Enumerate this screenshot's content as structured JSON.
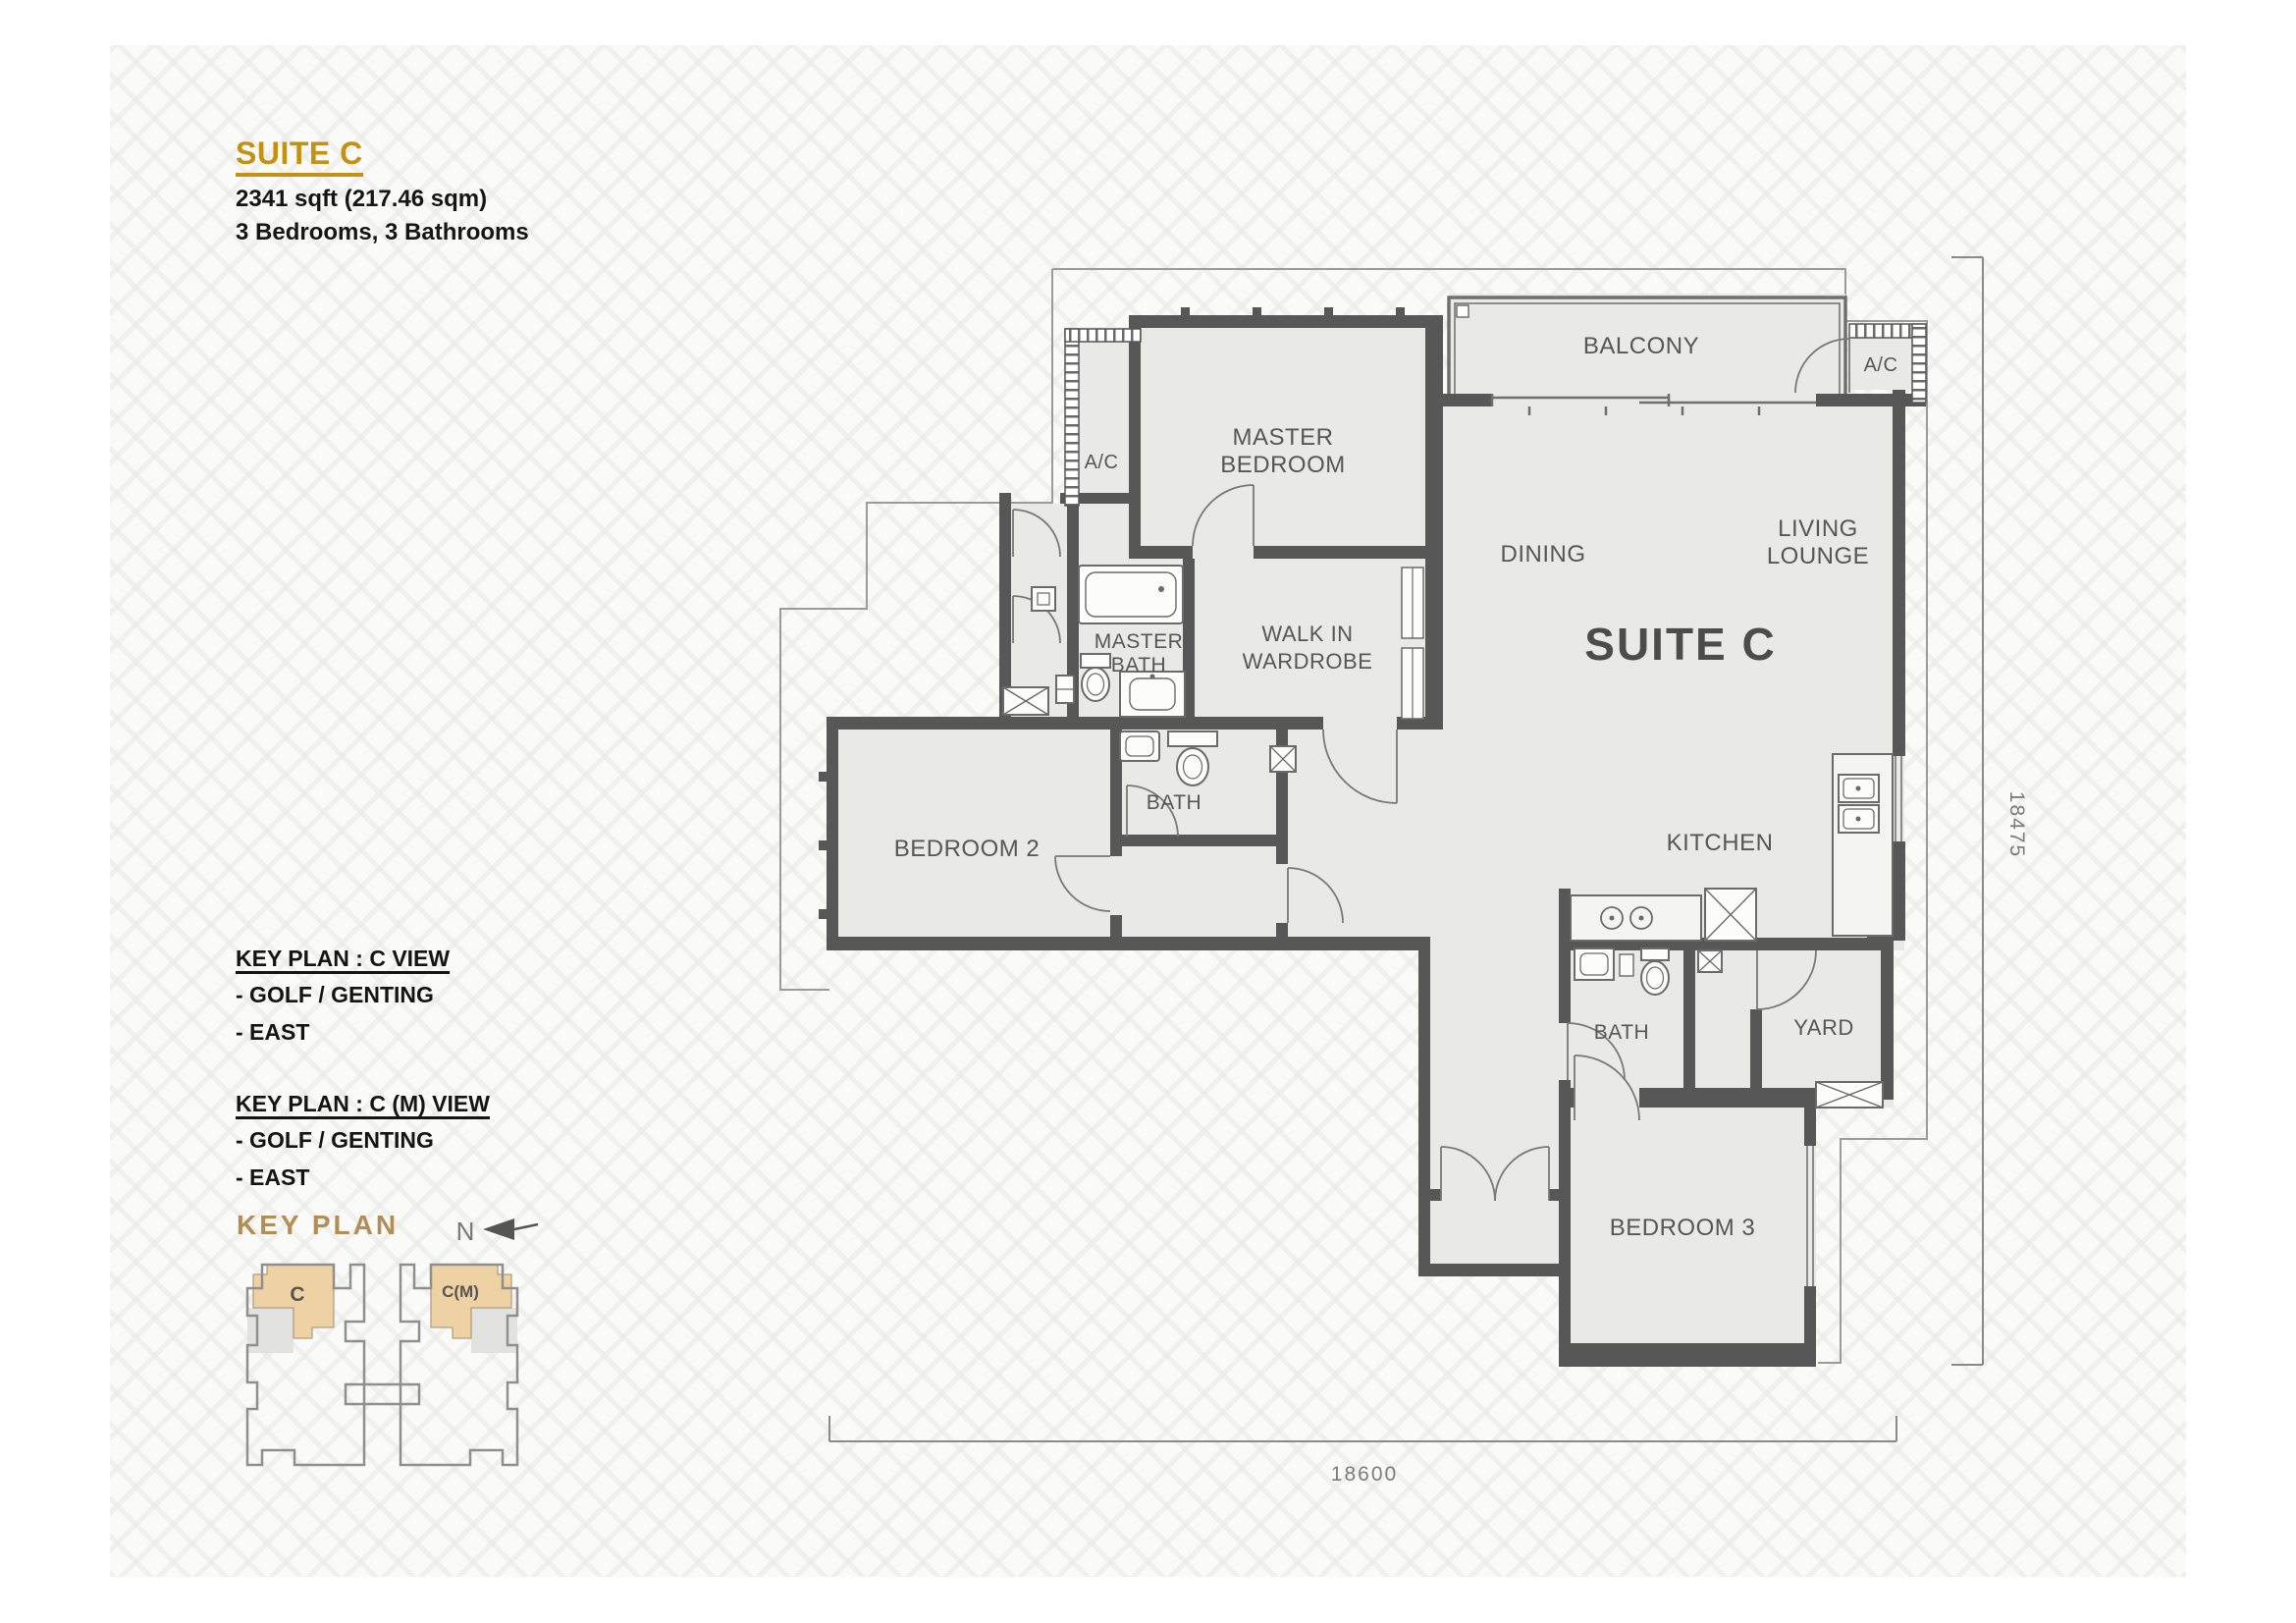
{
  "header": {
    "title": "SUITE C",
    "area": "2341 sqft (217.46 sqm)",
    "rooms": "3 Bedrooms, 3 Bathrooms"
  },
  "key_plan_views": [
    {
      "title": "KEY PLAN : C VIEW",
      "lines": [
        "- GOLF / GENTING",
        "- EAST"
      ]
    },
    {
      "title": "KEY PLAN : C (M) VIEW",
      "lines": [
        "- GOLF / GENTING",
        "- EAST"
      ]
    }
  ],
  "key_plan": {
    "heading": "KEY PLAN",
    "north": "N",
    "unit_c": "C",
    "unit_cm": "C(M)"
  },
  "floor_plan": {
    "labels": {
      "balcony": "BALCONY",
      "ac_right": "A/C",
      "ac_left": "A/C",
      "master_1": "MASTER",
      "master_2": "BEDROOM",
      "dining": "DINING",
      "living_1": "LIVING",
      "living_2": "LOUNGE",
      "suite": "SUITE C",
      "master_bath_1": "MASTER",
      "master_bath_2": "BATH",
      "walk_in_1": "WALK IN",
      "walk_in_2": "WARDROBE",
      "bedroom2": "BEDROOM 2",
      "bath2": "BATH",
      "kitchen": "KITCHEN",
      "bath3": "BATH",
      "yard": "YARD",
      "bedroom3": "BEDROOM 3"
    },
    "dimensions": {
      "right": "18475",
      "bottom": "18600"
    }
  },
  "colors": {
    "accent_gold": "#c39210",
    "keyplan_gold": "#b28e55",
    "wall": "#575757",
    "floor": "#e9e9e7",
    "highlight_beige": "#eed2a4",
    "line_gray": "#8a8a8a"
  }
}
